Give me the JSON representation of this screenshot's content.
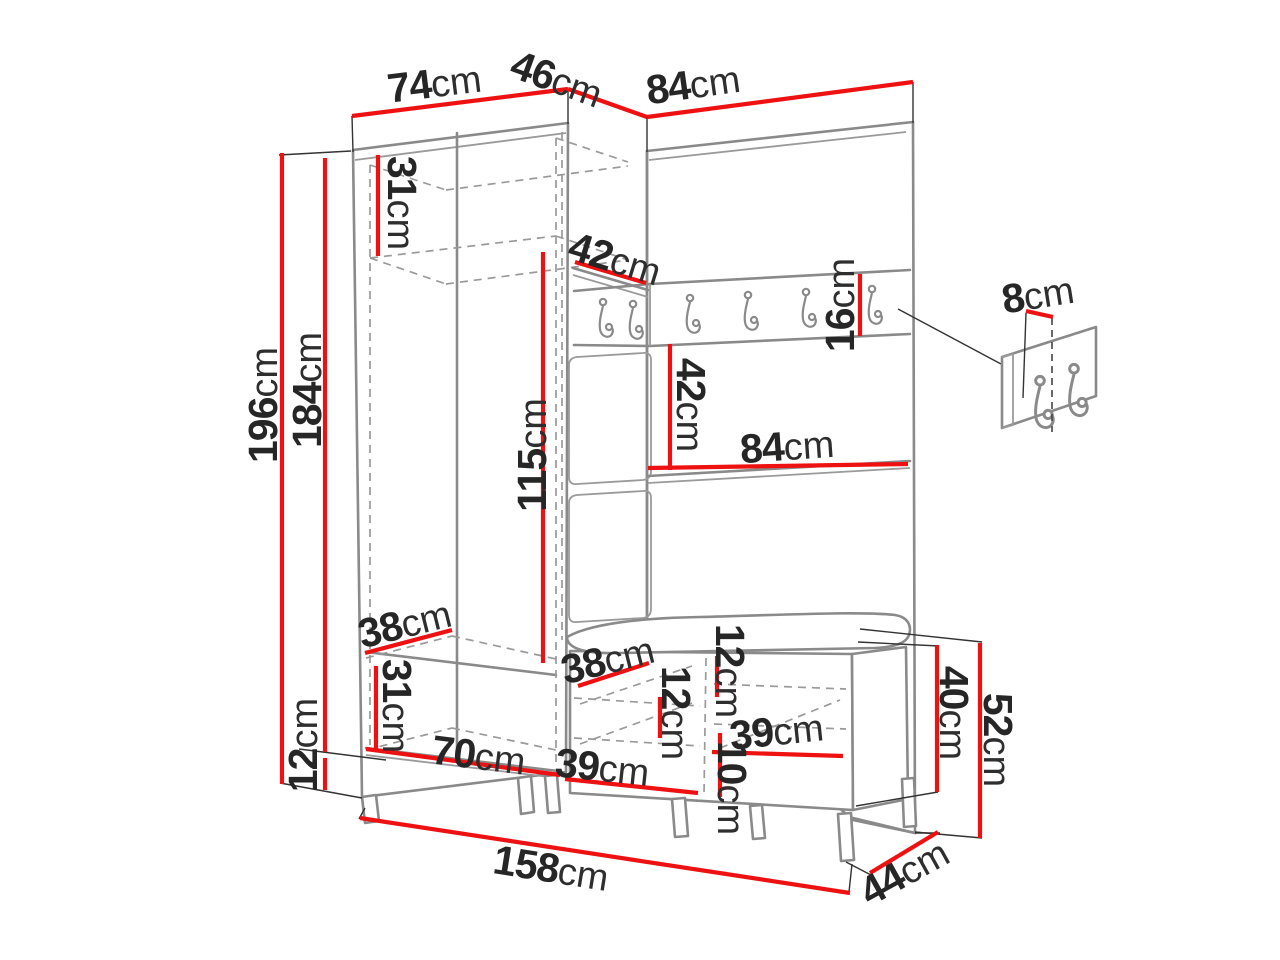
{
  "diagram": {
    "type": "furniture-dimension-diagram",
    "subject": "hallway wardrobe set with coat hooks and shoe bench",
    "unit": "cm",
    "colors": {
      "dimension_red": "#ee1111",
      "outline_gray": "#8a8a8a",
      "text_black": "#262626",
      "background": "#ffffff"
    },
    "dims": {
      "top_width": "74",
      "top_depth": "46",
      "top_panel_width": "84",
      "top_shelf_height": "31",
      "total_height": "196",
      "body_height": "184",
      "plinth_height": "12",
      "corner_shelf_depth": "42",
      "hook_rail_height": "16",
      "hanging_height": "115",
      "rail_to_shelf": "42",
      "panel_shelf_width": "84",
      "hook_offset": "8",
      "bottom_shelf_depth": "38",
      "bottom_section_height": "31",
      "bottom_width": "70",
      "bench_shelf_depth": "38",
      "bench_top_gap": "12",
      "bench_shelf_gap": "12",
      "bench_left_width": "39",
      "bench_right_width": "39",
      "bench_bottom_gap": "10",
      "bench_body_height": "40",
      "bench_total_height": "52",
      "total_width": "158",
      "total_depth": "44"
    }
  }
}
